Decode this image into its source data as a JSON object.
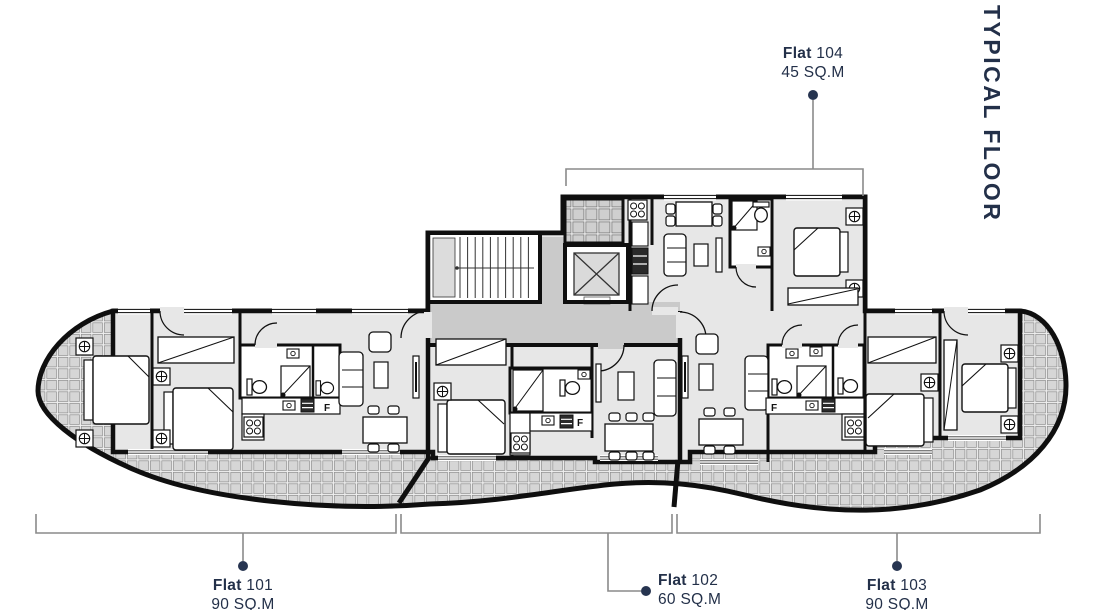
{
  "title": "TYPICAL FLOOR",
  "flat_labels": {
    "flat101": {
      "name": "Flat",
      "number": "101",
      "area": "90 SQ.M"
    },
    "flat102": {
      "name": "Flat",
      "number": "102",
      "area": "60 SQ.M"
    },
    "flat103": {
      "name": "Flat",
      "number": "103",
      "area": "90 SQ.M"
    },
    "flat104": {
      "name": "Flat",
      "number": "104",
      "area": "45 SQ.M"
    }
  },
  "plan": {
    "fridge_label": "F",
    "flats": [
      {
        "id": "101",
        "area_sqm": 90,
        "rooms": [
          "bedroom",
          "bedroom",
          "bathroom",
          "kitchen",
          "living-dining",
          "balcony"
        ]
      },
      {
        "id": "102",
        "area_sqm": 60,
        "rooms": [
          "bedroom",
          "bathroom",
          "kitchen",
          "living-dining",
          "balcony"
        ]
      },
      {
        "id": "103",
        "area_sqm": 90,
        "rooms": [
          "living-dining",
          "kitchen",
          "bathroom",
          "bathroom",
          "bedroom",
          "bedroom",
          "balcony"
        ]
      },
      {
        "id": "104",
        "area_sqm": 45,
        "rooms": [
          "kitchen",
          "living-dining",
          "bathroom",
          "bedroom",
          "entrance-balcony"
        ]
      }
    ],
    "core": [
      "staircase",
      "elevator",
      "corridor",
      "entrance-balcony"
    ]
  },
  "colors": {
    "label_text": "#233049",
    "walls": "#111111",
    "room_fill": "#e7e7e7",
    "corridor_fill": "#cacaca",
    "tile_fill": "#d6d6d6",
    "leader_line": "#8a8a8a"
  }
}
